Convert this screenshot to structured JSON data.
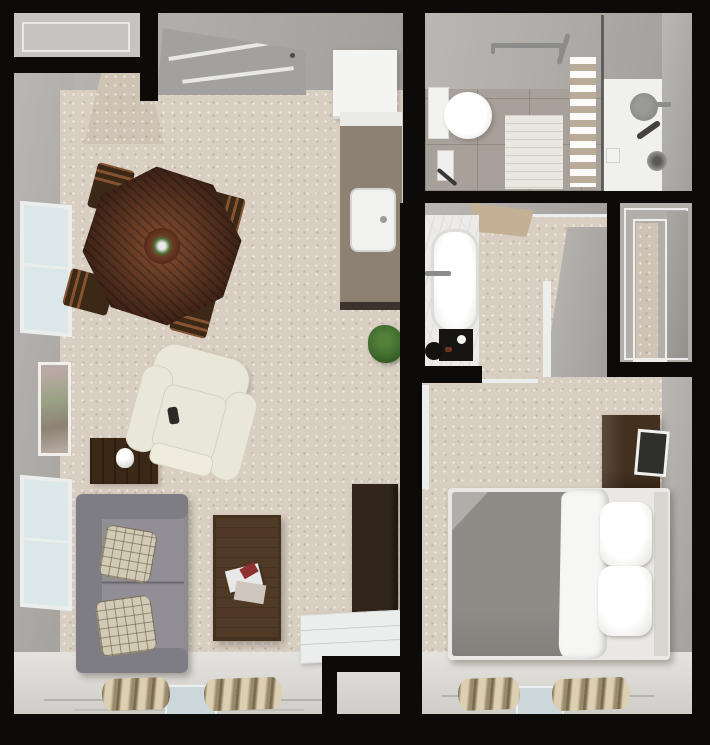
{
  "scene": {
    "kind": "3d-top-down-floor-plan",
    "description": "One-bedroom apartment rendering: living/dining area with kitchenette, bathroom with shower, bathtub alcove, closet, and bedroom",
    "visible_text": "",
    "rooms": [
      {
        "id": "living-dining-area",
        "objects": [
          "entry-door",
          "entry-closet",
          "dining-table",
          "dining-chair",
          "dining-centerpiece",
          "window",
          "window",
          "wall-art",
          "side-table",
          "table-lamp",
          "recliner",
          "sofa",
          "throw-pillow",
          "coffee-table",
          "magazines",
          "media-cabinet",
          "white-desk",
          "potted-plant",
          "refrigerator",
          "kitchen-counter",
          "kitchen-sink",
          "sliding-door",
          "curtains"
        ]
      },
      {
        "id": "bathroom",
        "objects": [
          "toilet",
          "toilet-paper-holder",
          "bath-mat",
          "towel-bar",
          "towel-shelf",
          "glass-shower-partition",
          "shower-head",
          "hand-shower",
          "shower-valve",
          "soap-dish"
        ]
      },
      {
        "id": "bathtub-alcove",
        "objects": [
          "bathtub",
          "marble-counter",
          "faucet",
          "bathroom-scale",
          "floor-mat",
          "open-door"
        ]
      },
      {
        "id": "closet",
        "objects": [
          "sliding-closet-doors"
        ]
      },
      {
        "id": "bedroom",
        "objects": [
          "bed",
          "duvet",
          "sheet",
          "pillow",
          "pillow",
          "headboard",
          "dresser",
          "television",
          "sliding-door",
          "curtains"
        ]
      }
    ]
  },
  "colors": {
    "wall_black": "#0c0b0a",
    "wall": "#b2afab",
    "wall_light": "#c6c4c0",
    "wall_panel": "#a29f9a",
    "carpet": "#d8cec2",
    "carpet_entry": "#cfc3b4",
    "floor_light": "#dcdad5",
    "tile": "#a8a199",
    "shower_white": "#f0f0ed",
    "glass": "#54524e",
    "fridge": "#f4f4f2",
    "counter": "#8d8174",
    "counter_top": "#eaeae8",
    "counter_base": "#3a342c",
    "sink": "#f1f1ef",
    "wood_dining": "#5b3322",
    "wood_dark": "#3c2817",
    "wood_walnut": "#45311f",
    "wood_dresser": "#44301f",
    "wood_cabinet": "#32261c",
    "sofa": "#8d8c91",
    "sofa_dark": "#7e7d83",
    "cushion": "#918f95",
    "plaid": "#d2cab5",
    "cream": "#e9e6da",
    "bed_duvet": "#8f8b86",
    "bed_white": "#f6f6f4",
    "bed_frame": "#e9e8e4",
    "headboard": "#d8d6d1",
    "curtain": "#bdae90",
    "glass_pane": "#ccd7da",
    "plant": "#3f6b2e",
    "marble": "#ecebe9",
    "scale_black": "#171513",
    "art": "#aa9f96",
    "window_glass": "#dbe7e8",
    "trim": "#eceded",
    "metal": "#8c8c8a",
    "tan_door": "#c4b195",
    "shelf_tan": "#d9cfc0",
    "mat": "#e9e7df",
    "tv_screen": "#2f2f2d"
  }
}
